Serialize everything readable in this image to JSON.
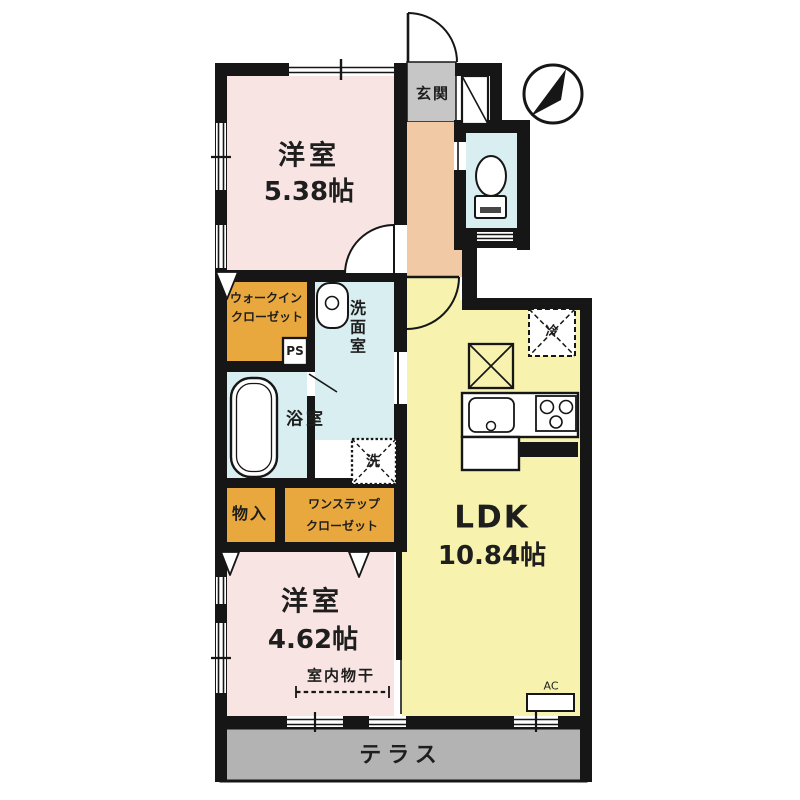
{
  "plan_title": "1LDK+2S floor plan",
  "rooms": {
    "bedroom1": {
      "name": "洋室",
      "area": "5.38帖"
    },
    "bedroom2": {
      "name": "洋室",
      "area": "4.62帖"
    },
    "ldk": {
      "name": "LDK",
      "area": "10.84帖"
    },
    "entrance": {
      "name": "玄関"
    },
    "washroom": {
      "name": "洗面室"
    },
    "bathroom": {
      "name": "浴室"
    },
    "walk_in_closet": {
      "line1": "ウォークイン",
      "line2": "クローゼット"
    },
    "one_step_closet": {
      "line1": "ワンステップ",
      "line2": "クローゼット"
    },
    "storage": {
      "name": "物入"
    },
    "terrace": {
      "name": "テラス"
    }
  },
  "annotations": {
    "pipe_space": "PS",
    "air_conditioner": "AC",
    "refrigerator": "冷",
    "washing_machine": "洗",
    "indoor_drying": "室内物干"
  },
  "icons": {
    "compass": "north-arrow-compass",
    "toilet": "toilet-fixture",
    "bathtub": "bathtub-fixture",
    "sink": "wash-basin",
    "kitchen": "sink-and-stove-counter"
  },
  "colors": {
    "wall": "#161616",
    "bedroom_fill": "#f8e5e3",
    "ldk_fill": "#f7f3ae",
    "wet_area_fill": "#d8eef0",
    "closet_fill": "#e9a83d",
    "hallway_fill": "#f1c9a4",
    "entrance_fill": "#c6c6c6",
    "terrace_fill": "#b3b3b3"
  }
}
